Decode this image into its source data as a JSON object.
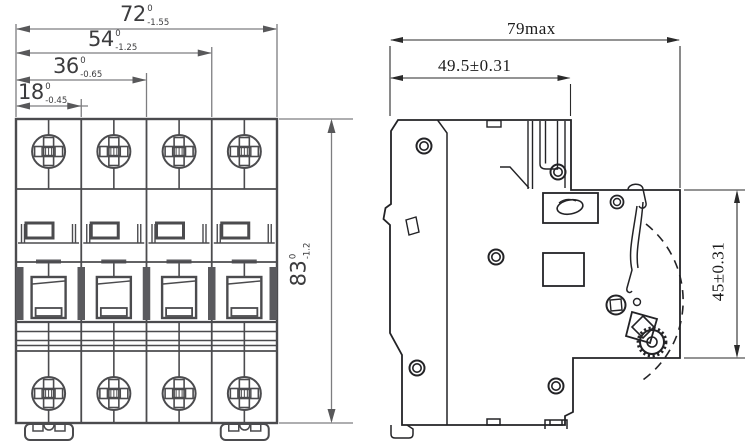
{
  "drawing_title": "4-pole circuit breaker outline dimension drawing",
  "front_view": {
    "description": "front view, 4 poles with screw terminals, toggle handles, DIN feet",
    "poles": 4,
    "dims": {
      "w72": {
        "value": "72",
        "tol_top": "0",
        "tol_bot": "-1.55"
      },
      "w54": {
        "value": "54",
        "tol_top": "0",
        "tol_bot": "-1.25"
      },
      "w36": {
        "value": "36",
        "tol_top": "0",
        "tol_bot": "-0.65"
      },
      "w18": {
        "value": "18",
        "tol_top": "0",
        "tol_bot": "-0.45"
      },
      "h83": {
        "value": "83",
        "tol_top": "0",
        "tol_bot": "-1.2"
      }
    }
  },
  "side_view": {
    "description": "side profile with DIN-rail latch, rivets and gear knob",
    "dims": {
      "w79": "79max",
      "w49": "49.5±0.31",
      "h45": "45±0.31"
    }
  },
  "colors": {
    "object_line_front": "#4b4b4e",
    "object_line_side": "#232326",
    "dimension_line": "#7d7d80",
    "text": "#3c3c3e",
    "background": "#ffffff"
  }
}
